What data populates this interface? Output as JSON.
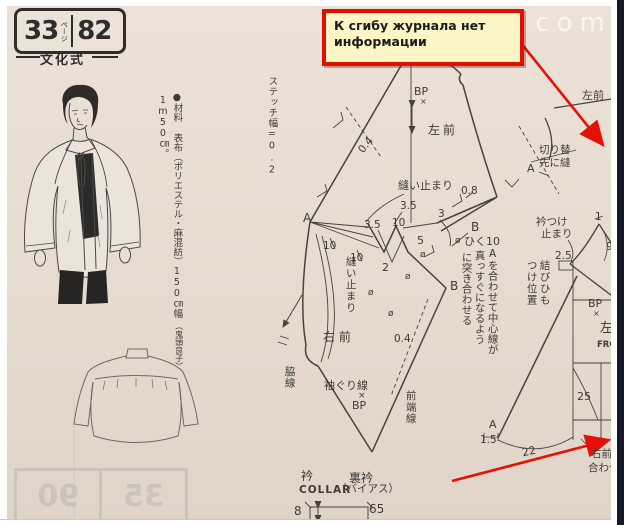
{
  "header": {
    "page_num": "33",
    "page_word": "ページ",
    "pattern_num": "82",
    "method": "文化式"
  },
  "watermark": "e.com",
  "annotation": {
    "line1": "К сгибу журнала нет",
    "line2": "информации"
  },
  "materials": {
    "main": "●材料 表布（ポリエステル・麻混紡）150㎝幅",
    "credit": "（鬼頭良子）",
    "amount": "1m50㎝。"
  },
  "diagram": {
    "stitch_width": "ステッチ幅=0.2",
    "left_front": "左前",
    "left_front_cut": "左前",
    "right_front": "右 前",
    "seam_stop": "縫い止まり",
    "side_line": "脇線",
    "armhole_line": "袖ぐり線",
    "front_edge_line": "前端線",
    "instruction_1": "Aを合わせて中心線が",
    "instruction_2": "真っすぐになるよう",
    "instruction_3": "に突き合わせる",
    "collar_stop_1": "衿つけ",
    "collar_stop_2": "止まり",
    "tie_position_1": "結びひも",
    "tie_position_2": "つけ位置",
    "subtract10": "ひく10",
    "cut_panel": "切り替",
    "sew_first": "先に縫",
    "left_char": "左",
    "front_abbr": "FRO",
    "right_front_join_1": "右前ヒ",
    "right_front_join_2": "合わせ",
    "bp": "BP",
    "cross": "×",
    "fold": "ø",
    "point_a": "A",
    "point_b": "B",
    "n04": "0.4",
    "n35": "3.5",
    "n10": "10",
    "n2": "2",
    "n5": "5",
    "n3": "3",
    "n08": "0.8",
    "n25": "2.5",
    "n1": "1",
    "n9": "9",
    "n25b": "25",
    "n15": "1.5",
    "n22": "22"
  },
  "collar": {
    "front": "衿",
    "back": "裏衿",
    "caption": "COLLAR",
    "bias": "（バイアス）",
    "height": "8",
    "width": "65"
  },
  "ghost": {
    "left": "35",
    "right": "90"
  }
}
